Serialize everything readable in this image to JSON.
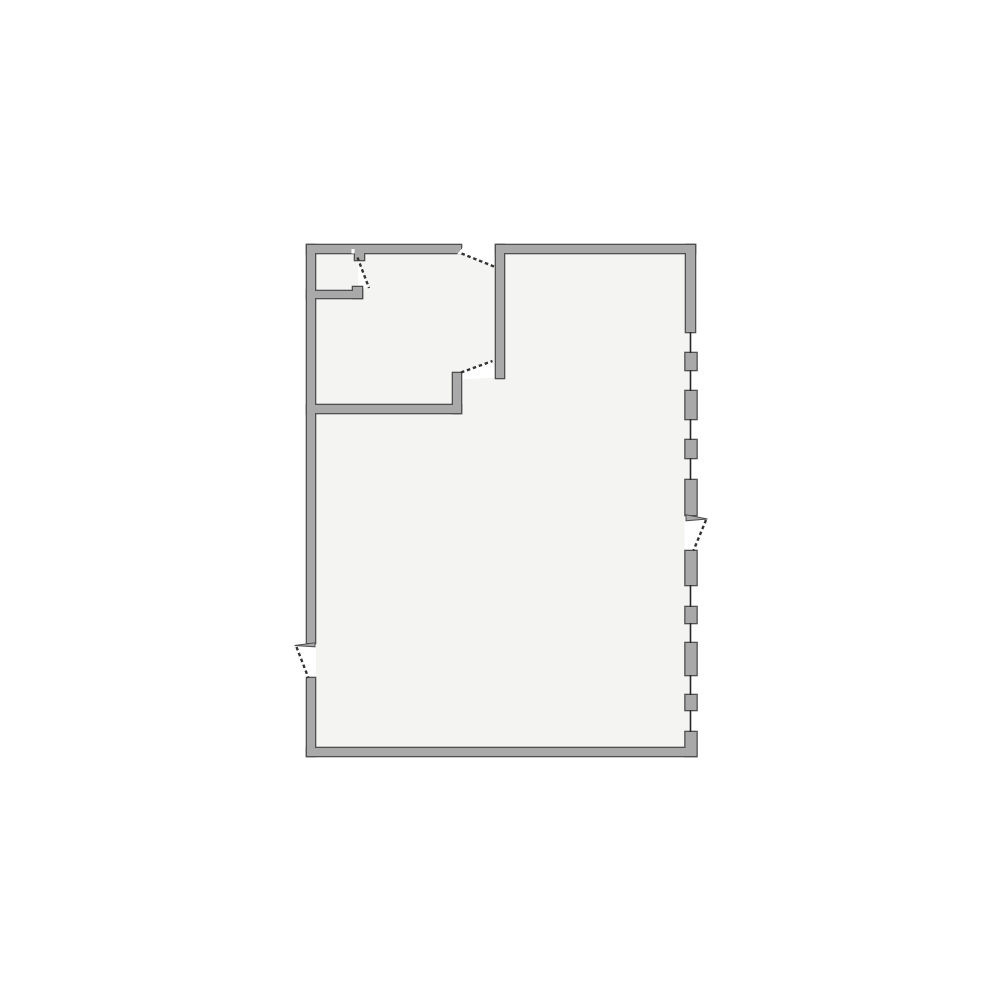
{
  "colors": {
    "background": "#ffffff",
    "floor": "#f4f4f3",
    "wall_fill": "#a9a9a9",
    "wall_outline": "#4f4f4f",
    "glass": "#262626",
    "door_leaf": "#333333"
  },
  "floor_plan": {
    "floor": {
      "x": 314,
      "y": 252,
      "w": 376,
      "h": 497
    },
    "walls": [
      {
        "id": "wall-left-upper",
        "x": 307,
        "y": 245,
        "w": 8,
        "h": 398
      },
      {
        "id": "wall-left-lower",
        "x": 307,
        "y": 678,
        "w": 8,
        "h": 78
      },
      {
        "id": "wall-top-left",
        "x": 307,
        "y": 245,
        "w": 154,
        "h": 8
      },
      {
        "id": "wall-top-right",
        "x": 496,
        "y": 245,
        "w": 199,
        "h": 8
      },
      {
        "id": "wall-bottom",
        "x": 307,
        "y": 748,
        "w": 389,
        "h": 8
      },
      {
        "id": "wall-right-upper-solid",
        "x": 686,
        "y": 245,
        "w": 9,
        "h": 87
      },
      {
        "id": "wall-right-bottom-corner",
        "x": 685.5,
        "y": 732,
        "w": 11,
        "h": 24
      },
      {
        "id": "wall-interior-vertical",
        "x": 496,
        "y": 245,
        "w": 8,
        "h": 133
      },
      {
        "id": "wall-interior-horizontal",
        "x": 307,
        "y": 405,
        "w": 154,
        "h": 8
      },
      {
        "id": "wall-interior-door-jamb",
        "x": 453,
        "y": 373,
        "w": 8,
        "h": 40
      },
      {
        "id": "wall-closet-bottom",
        "x": 307,
        "y": 291,
        "w": 55,
        "h": 7
      },
      {
        "id": "wall-closet-jamb-lip",
        "x": 353,
        "y": 287,
        "w": 9,
        "h": 11
      },
      {
        "id": "wall-closet-hinge-stub",
        "x": 355,
        "y": 253,
        "w": 9,
        "h": 7
      }
    ],
    "door_openings": [
      {
        "id": "top-door-opening",
        "x": 460.5,
        "y": 244,
        "w": 35.5,
        "h": 10.5
      },
      {
        "id": "left-door-opening",
        "x": 306,
        "y": 643.5,
        "w": 10,
        "h": 34.5
      },
      {
        "id": "right-door-opening",
        "x": 684.5,
        "y": 515.5,
        "w": 12,
        "h": 35.5
      }
    ],
    "swing_wedges": [
      {
        "id": "top-door-swing-wedge",
        "points": "462,254.2 493.5,254.2 493.5,266"
      },
      {
        "id": "closet-door-swing-wedge",
        "points": "358,259 369,288 358,288"
      },
      {
        "id": "interior-door-swing-wedge",
        "points": "461.5,372 492.5,360.5 496,377.5 461.5,379.5"
      }
    ],
    "hinge_notches": [
      {
        "id": "closet-door-hinge-notch",
        "points": "351.5,249 354.5,249 354.5,253.5 351.5,253.5"
      },
      {
        "id": "top-door-end-chamfer",
        "points": "457,254.2 463,254.2 463,247.5"
      }
    ],
    "jamb_slivers": [
      {
        "id": "left-door-jamb-sliver",
        "points": "294.5,645.5 315,642.8 315,646.8"
      },
      {
        "id": "right-door-jamb-sliver",
        "points": "686,514.8 707.5,519 686,520.8"
      }
    ],
    "windows": {
      "glass_x": 690.5,
      "glass_w": 1.6,
      "segments": [
        [
          332,
          353
        ],
        [
          370,
          391
        ],
        [
          419,
          440
        ],
        [
          458,
          480
        ],
        [
          585,
          607
        ],
        [
          623,
          643
        ],
        [
          675,
          695
        ],
        [
          710,
          732
        ]
      ],
      "block_x": 685.5,
      "block_w": 11,
      "blocks": [
        {
          "y": 353,
          "h": 17
        },
        {
          "y": 391,
          "h": 28
        },
        {
          "y": 440,
          "h": 18
        },
        {
          "y": 480,
          "h": 35
        },
        {
          "y": 551,
          "h": 34
        },
        {
          "y": 607,
          "h": 16
        },
        {
          "y": 643,
          "h": 32
        },
        {
          "y": 695,
          "h": 15
        }
      ]
    },
    "door_leaves": [
      {
        "id": "top-door-leaf",
        "x1": 461.5,
        "y1": 253.5,
        "x2": 494,
        "y2": 266.5
      },
      {
        "id": "closet-door-leaf",
        "x1": 357.5,
        "y1": 257.5,
        "x2": 369,
        "y2": 288
      },
      {
        "id": "interior-door-leaf",
        "x1": 461,
        "y1": 372.5,
        "x2": 492.5,
        "y2": 361
      },
      {
        "id": "left-door-leaf",
        "x1": 296.5,
        "y1": 647,
        "x2": 308.5,
        "y2": 678
      },
      {
        "id": "right-door-leaf",
        "x1": 706,
        "y1": 520,
        "x2": 693.5,
        "y2": 550.5
      }
    ]
  }
}
